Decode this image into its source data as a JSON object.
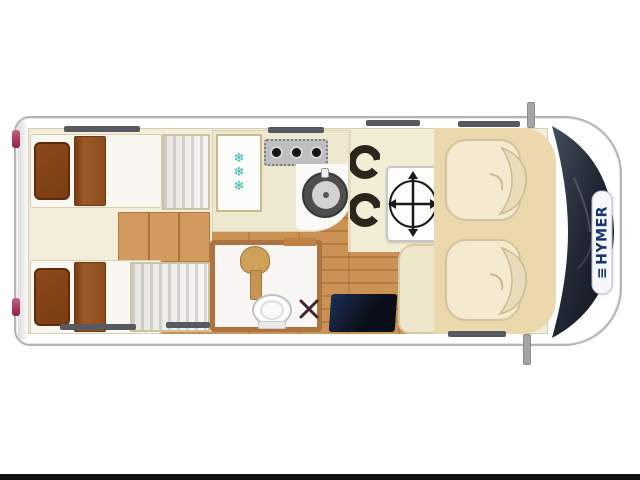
{
  "brand": {
    "logo_mark": "≡",
    "name": "HYMER"
  },
  "floorplan": {
    "view": "motorhome-top-down-layout",
    "zones": {
      "rear_bedroom": {
        "single_beds": 2,
        "pillows_per_bed": 2,
        "wardrobes": 2,
        "steps": true
      },
      "kitchen": {
        "fridge": true,
        "hob": true,
        "sink": true
      },
      "bathroom": {
        "washbasin": true,
        "toilet": true,
        "shower": true
      },
      "dinette": {
        "adjustable_table": true,
        "seats": 2,
        "side_bench": true
      },
      "entry": {
        "step_mat": true
      },
      "cab": {
        "swivel_seats": [
          "passenger",
          "driver"
        ],
        "mirrors": 2,
        "tail_lights": 2
      }
    }
  },
  "kitchen": {
    "snowflake_glyph": "❄",
    "snowflake_count": 3,
    "burner_count": 3
  },
  "colors": {
    "body_white": "#ffffff",
    "outline_gray": "#b4b4b4",
    "interior_cream": "#f3edd9",
    "wood_floor": "#c08044",
    "cab_floor_beige": "#ebd8ad",
    "windshield_navy": "#2c3440",
    "entry_mat_navy": "#16233f",
    "pillow_brown": "#7a3c12",
    "bathroom_wall_wood": "#ab7440",
    "snowflake_teal": "#2fb3a8",
    "tail_light_red": "#8c2340",
    "logo_navy": "#16356f"
  }
}
